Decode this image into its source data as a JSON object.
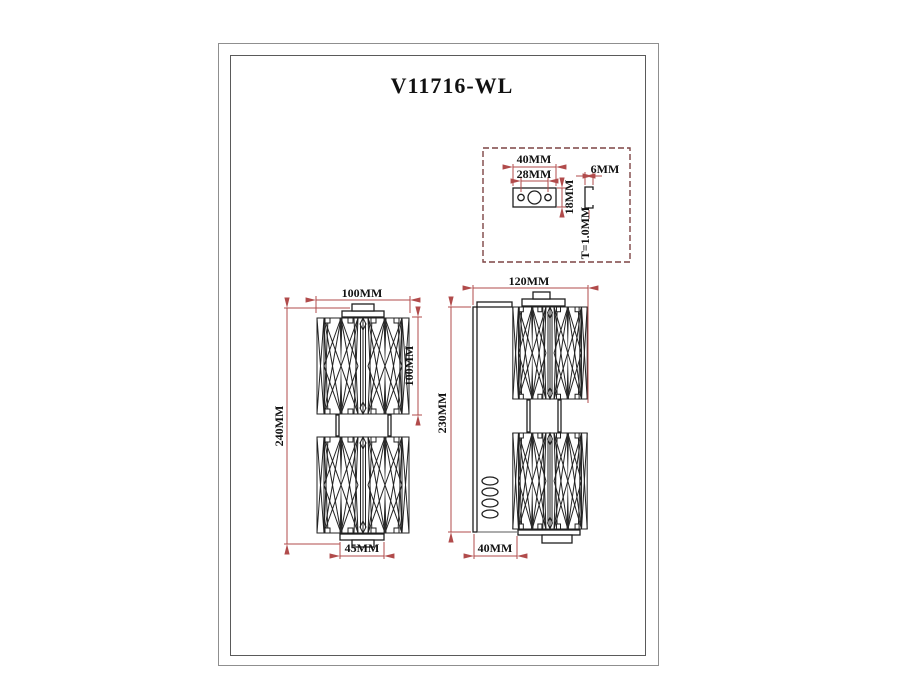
{
  "sheet": {
    "title": "V11716-WL"
  },
  "colors": {
    "dimension_red": "#b14b4b",
    "drawing_line": "#1f1f1f",
    "detail_box_border": "#7d4444"
  },
  "detail_box": {
    "plate_width": "40MM",
    "hole_spacing": "28MM",
    "plate_height": "18MM",
    "flange_depth": "6MM",
    "material_thickness": "T=1.0MM"
  },
  "front_view": {
    "shade_width": "100MM",
    "shade_height": "100MM",
    "overall_height": "240MM",
    "base_width": "45MM"
  },
  "side_view": {
    "overall_depth": "120MM",
    "overall_height": "230MM",
    "backplate_offset": "40MM"
  }
}
